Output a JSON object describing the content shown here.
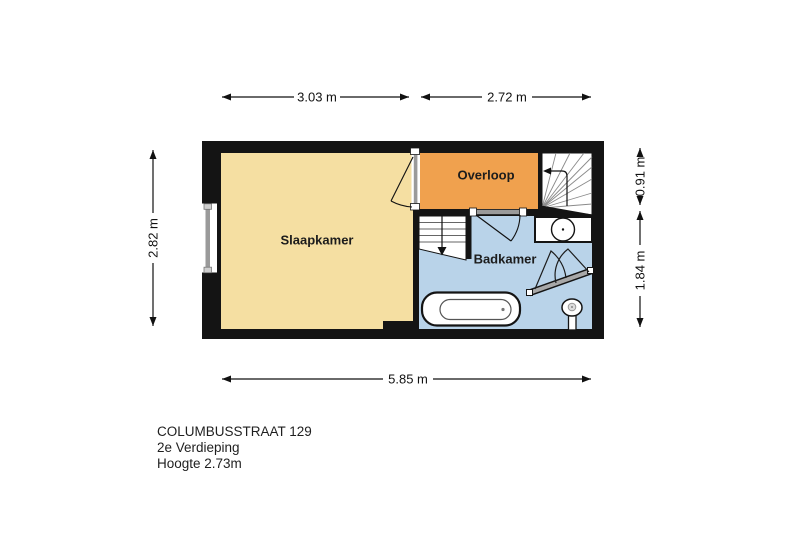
{
  "floor_plan": {
    "rooms": {
      "bedroom": {
        "label": "Slaapkamer",
        "color": "#F5DFA2"
      },
      "landing": {
        "label": "Overloop",
        "color": "#F0A14E"
      },
      "bathroom": {
        "label": "Badkamer",
        "color": "#B9D3E9"
      }
    },
    "dimensions": {
      "top_left": "3.03 m",
      "top_right": "2.72 m",
      "left": "2.82 m",
      "right_top": "0.91 m",
      "right_bottom": "1.84 m",
      "bottom": "5.85 m"
    },
    "fixtures": {
      "bathtub": "bathtub",
      "toilet": "toilet",
      "sink": "sink",
      "stairs_up": "stairs-up",
      "stairs_down": "stairs-down",
      "window": "window",
      "shower_screen": "shower-screen"
    },
    "wall_color": "#141414"
  },
  "title_block": {
    "address": "COLUMBUSSTRAAT 129",
    "floor": "2e Verdieping",
    "ceiling_height": "Hoogte 2.73m"
  }
}
